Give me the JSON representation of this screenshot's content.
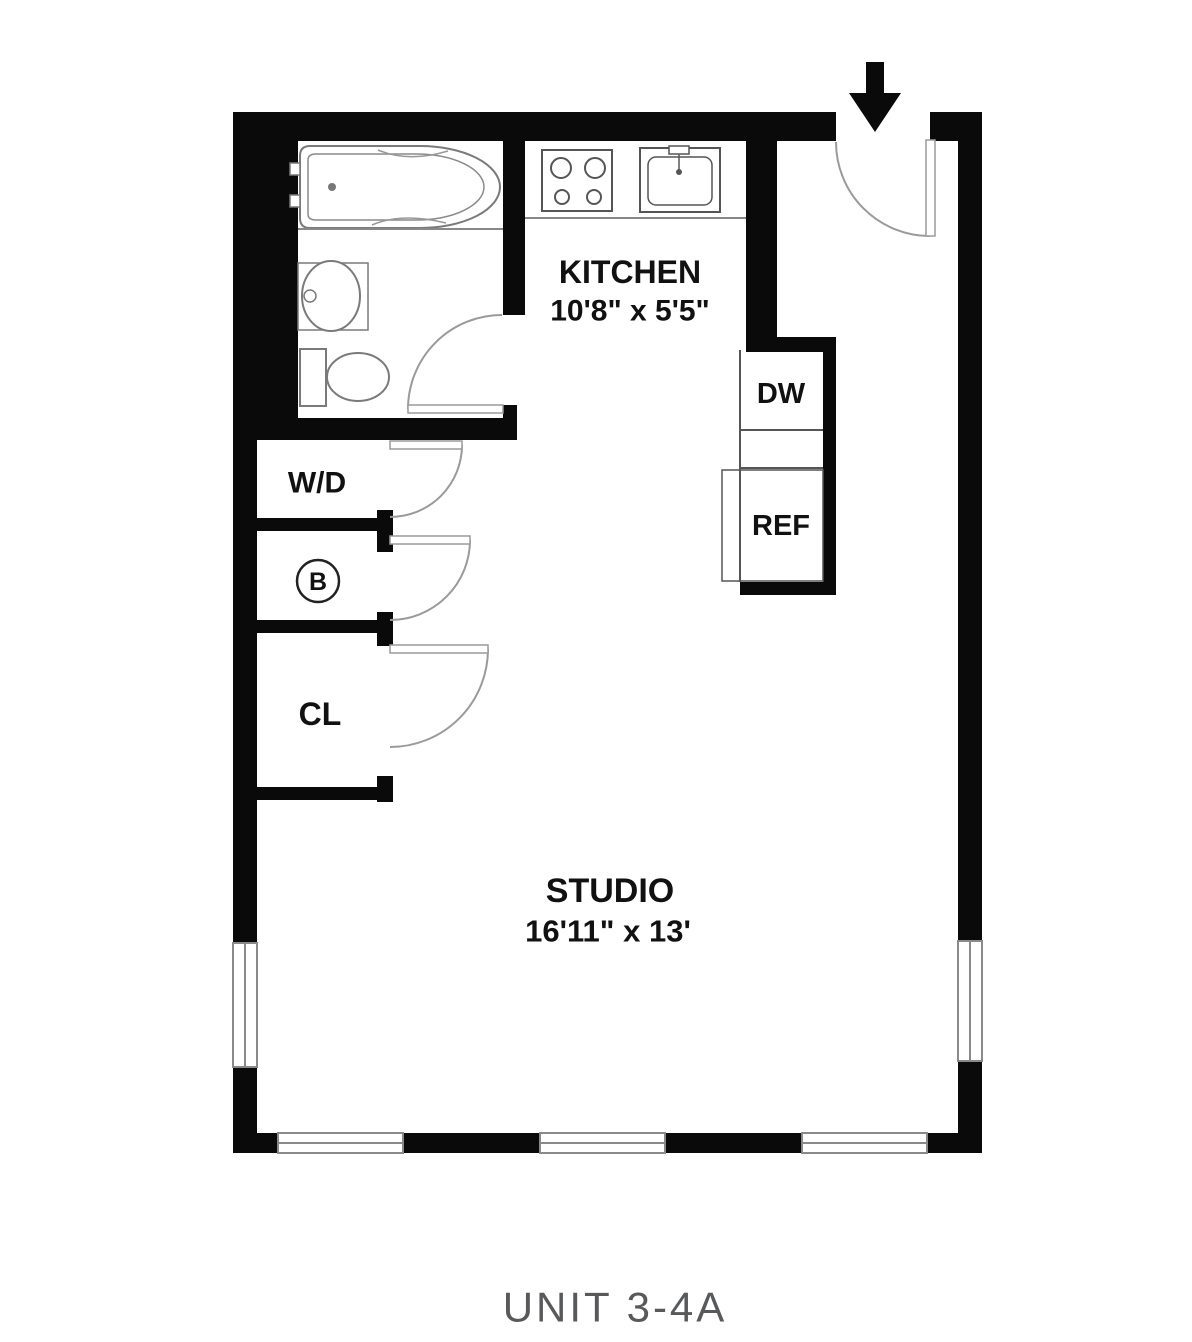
{
  "title": "Floor plan",
  "caption": "UNIT 3-4A",
  "rooms": {
    "kitchen": {
      "label": "KITCHEN",
      "dims": "10'8\" x 5'5\""
    },
    "studio": {
      "label": "STUDIO",
      "dims": "16'11\" x 13'"
    },
    "washer_dryer": {
      "label": "W/D"
    },
    "boiler": {
      "label": "B"
    },
    "closet": {
      "label": "CL"
    },
    "dishwasher": {
      "label": "DW"
    },
    "refrigerator": {
      "label": "REF"
    }
  },
  "features": {
    "entry": "entry door with swing arc and approach arrow",
    "windows": [
      "left wall window",
      "right wall window",
      "bottom wall window 1",
      "bottom wall window 2",
      "bottom wall window 3"
    ],
    "fixtures": [
      "bathtub",
      "bathroom sink",
      "toilet",
      "stove",
      "kitchen sink"
    ]
  },
  "palette": {
    "wall": "#0a0a0a",
    "fixture_line": "#7a7a7a",
    "appliance_line": "#555555",
    "door_line": "#9a9a9a",
    "window_line": "#8a8a8a",
    "label": "#111111",
    "caption": "#58595b",
    "background": "#ffffff"
  }
}
